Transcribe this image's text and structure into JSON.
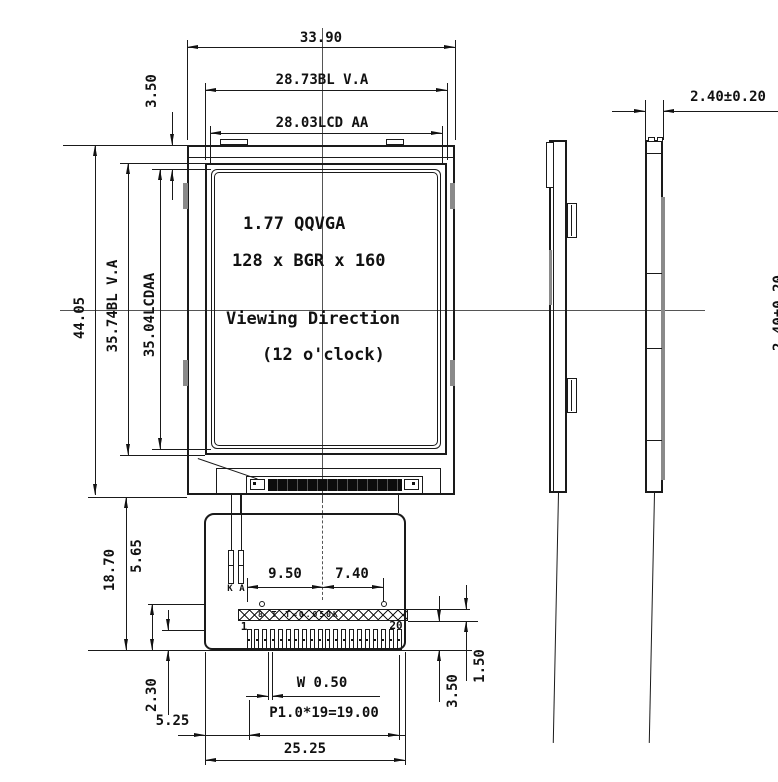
{
  "panel_text": {
    "line1": "1.77  QQVGA",
    "line2": "128 x BGR x 160",
    "line3": "Viewing Direction",
    "line4": "(12 o'clock)"
  },
  "dimensions": {
    "overall_width": "33.90",
    "bl_va_width": "28.73BL V.A",
    "lcd_aa_width": "28.03LCD AA",
    "top_margin": "3.50",
    "overall_height": "44.05",
    "bl_va_height": "35.74BL V.A",
    "lcd_aa_height": "35.04LCDAA",
    "thickness": "2.40±0.20",
    "thickness_clipped": "2.40±0.20",
    "fpc_total_length": "18.70",
    "fpc_upper_length": "5.65",
    "hole_left_offset": "9.50",
    "hole_right_offset": "7.40",
    "pin_exposed_length": "2.30",
    "pin_edge_offset": "5.25",
    "pin_width": "W 0.50",
    "pin_pitch_total": "P1.0*19=19.00",
    "connector_width": "25.25",
    "stiffener_height": "1.50",
    "pin_area_height": "3.50"
  },
  "connector": {
    "pin_count": 20,
    "first_pin_label": "1",
    "last_pin_label": "20",
    "cathode_label": "K",
    "anode_label": "A",
    "stiffener_note": "8 T T=0.050K"
  },
  "colors": {
    "line": "#1a1a1a",
    "shade": "#8a8a8a",
    "cog_strip": "#0d0d0d"
  }
}
